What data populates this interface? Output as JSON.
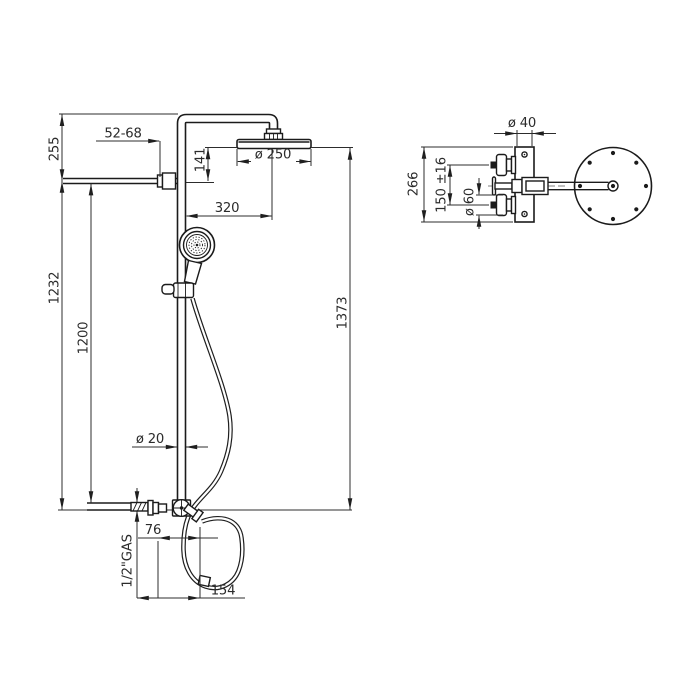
{
  "background": "#ffffff",
  "line_colors": {
    "object": "#1b1b1b",
    "dimension": "#2c2c2c",
    "text": "#2b2b2b"
  },
  "front_view": {
    "labels": {
      "wall_distance_range": "52-68",
      "top_offset": "255",
      "head_to_arm": "141",
      "head_diameter": "ø 250",
      "head_center_offset": "320",
      "arm_to_inlet_height": "1232",
      "slide_rail_height": "1200",
      "total_height": "1373",
      "pipe_diameter": "ø 20",
      "inlet_thread": "1/2\"GAS",
      "inlet_to_axis": "76",
      "inlet_to_outlet": "154"
    }
  },
  "side_view": {
    "labels": {
      "wall_bar_width": "ø 40",
      "wall_bar_height": "266",
      "handle_spacing": "150 ±16",
      "escutcheon_diameter": "ø 60"
    }
  }
}
